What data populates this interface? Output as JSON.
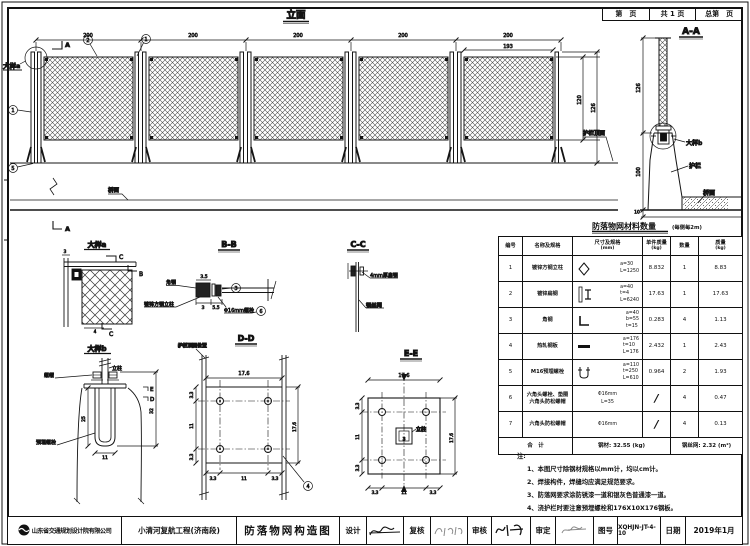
{
  "sheet": {
    "page_header": {
      "page_no": "第　页",
      "total": "共 1 页",
      "overall": "总第　页"
    }
  },
  "elevation": {
    "title": "立面",
    "dims_top": [
      "200",
      "200",
      "200",
      "200",
      "200"
    ],
    "dim_inner": "193",
    "dim_mesh_height": "120",
    "dim_total_height": "126",
    "detail_a_ref": "大样a",
    "deck_label": "桥面",
    "rail_top_label": "护栏顶面",
    "cut_label": "A",
    "bubble_1": "1",
    "bubble_2": "2",
    "bubble_5": "5"
  },
  "section_aa": {
    "title": "A-A",
    "dim_post": "126",
    "dim_parapet": "100",
    "dim_slab": "10",
    "detail_b_ref": "大样b",
    "rail_label": "护栏",
    "deck_label": "桥面"
  },
  "detail_a": {
    "title": "大样a",
    "cut_c": "C",
    "cut_b": "B",
    "dim_post": "3",
    "dim_gap": "4"
  },
  "section_bb": {
    "title": "B-B",
    "angle_label": "角钢",
    "post_label": "镀锌方钢立柱",
    "bolt_label": "Φ16mm螺栓",
    "dim_1": "3.5",
    "dim_2": "3",
    "dim_3": "5.5",
    "bubble_3": "3",
    "bubble_6": "6"
  },
  "section_cc": {
    "title": "C-C",
    "flat_label": "4mm厚扁钢",
    "mesh_label": "钢丝网"
  },
  "detail_b": {
    "title": "大样b",
    "post_label": "立柱",
    "nut_label": "螺帽",
    "anchor_label": "预埋螺栓",
    "dim_depth": "25",
    "dim_width": "11",
    "dim_height": "32",
    "cut_e": "E",
    "cut_d": "D"
  },
  "section_dd": {
    "title": "D-D",
    "rail_label": "护栏顶面位置",
    "dim_top": "17.6",
    "dim_side": "17.6",
    "dims_left": [
      "3.3",
      "11",
      "3.3"
    ],
    "dims_bottom": [
      "3.3",
      "11",
      "3.3"
    ],
    "bubble_4": "4"
  },
  "section_ee": {
    "title": "E-E",
    "post_label": "立柱",
    "dim_top": "17.6",
    "dim_side": "17.6",
    "dim_post": "3",
    "dims_left": [
      "3.3",
      "11",
      "3.3"
    ],
    "dims_bottom": [
      "3.3",
      "11",
      "3.3"
    ]
  },
  "material_table": {
    "title": "防落物网材料数量",
    "subtitle": "(每侧每2m)",
    "headers": {
      "no": "编号",
      "name": "名称及规格",
      "size": "尺寸及规格",
      "size_unit": "(mm)",
      "unit_weight": "单件质量",
      "unit_weight_unit": "(kg)",
      "qty": "数量",
      "weight": "质量",
      "weight_unit": "(kg)"
    },
    "rows": [
      {
        "no": "1",
        "name": [
          "镀锌方钢立柱"
        ],
        "dims": [
          "a=30",
          "L=1250"
        ],
        "unit_weight": "8.832",
        "qty": "1",
        "weight": "8.83"
      },
      {
        "no": "2",
        "name": [
          "镀锌扁钢"
        ],
        "dims": [
          "a=40",
          "t=4",
          "L=6240"
        ],
        "unit_weight": "17.63",
        "qty": "1",
        "weight": "17.63"
      },
      {
        "no": "3",
        "name": [
          "角钢"
        ],
        "dims": [
          "a=40",
          "b=55",
          "t=15"
        ],
        "unit_weight": "0.283",
        "qty": "4",
        "weight": "1.13"
      },
      {
        "no": "4",
        "name": [
          "热轧钢板"
        ],
        "dims": [
          "a=176",
          "t=10",
          "L=176"
        ],
        "unit_weight": "2.432",
        "qty": "1",
        "weight": "2.43"
      },
      {
        "no": "5",
        "name": [
          "M16预埋螺栓"
        ],
        "dims": [
          "a=110",
          "t=250",
          "L=610"
        ],
        "unit_weight": "0.964",
        "qty": "2",
        "weight": "1.93"
      },
      {
        "no": "6",
        "name": [
          "六角头螺栓、垫圈",
          "六角头防松螺帽"
        ],
        "dims": [
          "Φ16mm",
          "L=35"
        ],
        "unit_weight": "/",
        "qty": "4",
        "weight": "0.47"
      },
      {
        "no": "7",
        "name": [
          "六角头防松螺帽"
        ],
        "dims": [
          "Φ16mm"
        ],
        "unit_weight": "/",
        "qty": "4",
        "weight": "0.13"
      }
    ],
    "total": {
      "label": "合　计",
      "steel": "钢材: 32.55 (kg)",
      "mesh": "钢丝网: 2.32 (m²)"
    }
  },
  "notes": {
    "title": "注:",
    "items": [
      "1、本图尺寸除钢材规格以mm计，均以cm计。",
      "2、焊接构件，焊缝均应满足规范要求。",
      "3、防落网要求涂防锈漆一道和银灰色普通漆一道。",
      "4、浇护栏时要注意预埋螺栓和176X10X176钢板。"
    ]
  },
  "titleblock": {
    "company": "山东省交通规划设计院有限公司",
    "project": "小清河复航工程(济南段)",
    "drawing_title": "防落物网构造图",
    "design_label": "设计",
    "check_label": "复核",
    "review_label": "审核",
    "approve_label": "审定",
    "fig_no_label": "图号",
    "fig_no": "XQHJN-JT-4-10",
    "date_label": "日期",
    "date": "2019年1月"
  }
}
